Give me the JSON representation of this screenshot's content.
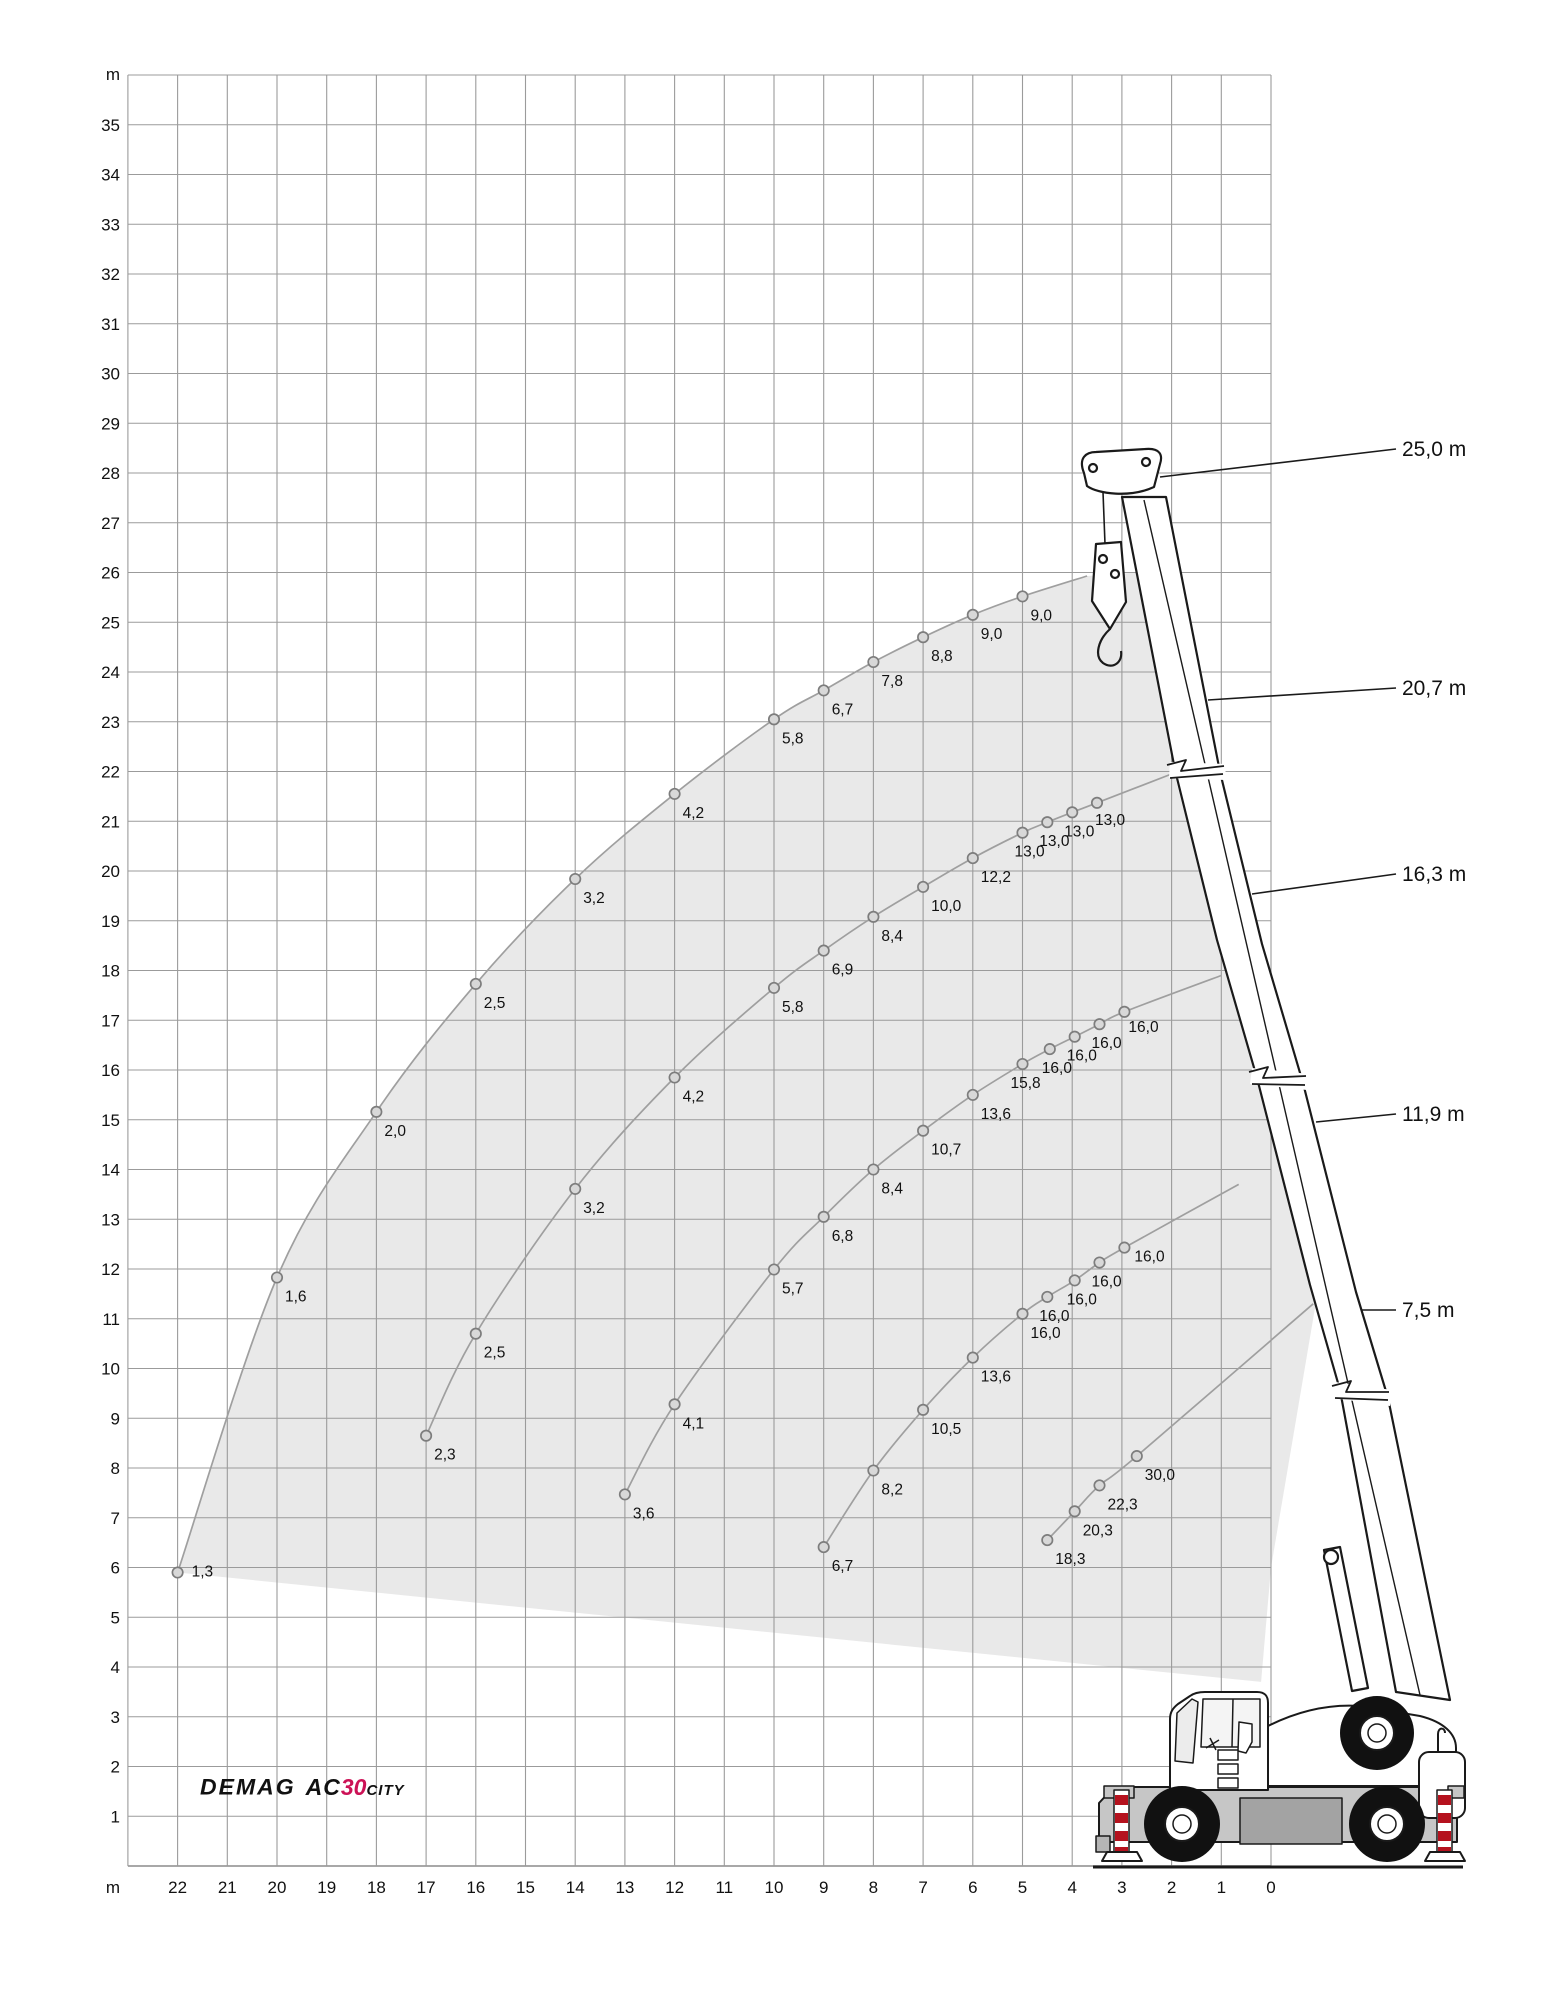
{
  "logo": {
    "brand": "DEMAG",
    "model_prefix": "AC",
    "model_number": "30",
    "model_suffix": "CITY",
    "accent": "#cc1256"
  },
  "colors": {
    "grid": "#9b9b9b",
    "envelope": "#e9e9e9",
    "curve": "#9f9f9f",
    "marker_fill": "#d8d8d8",
    "marker_stroke": "#7d7d7d",
    "text": "#111111",
    "crane_outline": "#1a1a1a",
    "deck": "#c6c6c6",
    "deck_dark": "#a3a3a3",
    "outrigger_red": "#b5121e"
  },
  "chart_data": {
    "type": "line",
    "title": "DEMAG AC30 City crane working range / load chart",
    "xlabel": "m",
    "ylabel": "m",
    "x_axis": {
      "unit": "m",
      "min": 0,
      "max": 23,
      "reversed": true,
      "tick_labels": [
        "22",
        "21",
        "20",
        "19",
        "18",
        "17",
        "16",
        "15",
        "14",
        "13",
        "12",
        "11",
        "10",
        "9",
        "8",
        "7",
        "6",
        "5",
        "4",
        "3",
        "2",
        "1",
        "0"
      ]
    },
    "y_axis": {
      "unit": "m",
      "min": 0,
      "max": 36,
      "tick_labels": [
        "35",
        "34",
        "33",
        "32",
        "31",
        "30",
        "29",
        "28",
        "27",
        "26",
        "25",
        "24",
        "23",
        "22",
        "21",
        "20",
        "19",
        "18",
        "17",
        "16",
        "15",
        "14",
        "13",
        "12",
        "11",
        "10",
        "9",
        "8",
        "7",
        "6",
        "5",
        "4",
        "3",
        "2",
        "1"
      ]
    },
    "grid": true,
    "legend_position": "right",
    "series": [
      {
        "name": "boom 25,0 m",
        "boom_length_label": "25,0 m",
        "points": [
          [
            22,
            5.9,
            "1,3",
            14,
            4
          ],
          [
            20,
            11.83,
            "1,6"
          ],
          [
            18,
            15.16,
            "2,0"
          ],
          [
            16,
            17.73,
            "2,5"
          ],
          [
            14,
            19.84,
            "3,2"
          ],
          [
            12,
            21.55,
            "4,2"
          ],
          [
            10,
            23.05,
            "5,8"
          ],
          [
            9,
            23.63,
            "6,7"
          ],
          [
            8,
            24.2,
            "7,8"
          ],
          [
            7,
            24.7,
            "8,8"
          ],
          [
            6,
            25.15,
            "9,0"
          ],
          [
            5,
            25.52,
            "9,0"
          ]
        ],
        "end": [
          3.7,
          25.93
        ]
      },
      {
        "name": "boom 20,7 m",
        "boom_length_label": "20,7 m",
        "points": [
          [
            17,
            8.65,
            "2,3"
          ],
          [
            16,
            10.7,
            "2,5"
          ],
          [
            14,
            13.61,
            "3,2"
          ],
          [
            12,
            15.85,
            "4,2"
          ],
          [
            10,
            17.65,
            "5,8"
          ],
          [
            9,
            18.4,
            "6,9"
          ],
          [
            8,
            19.08,
            "8,4"
          ],
          [
            7,
            19.68,
            "10,0"
          ],
          [
            6,
            20.26,
            "12,2"
          ],
          [
            5,
            20.77,
            "13,0",
            -8,
            24
          ],
          [
            4.5,
            20.98,
            "13,0",
            -8,
            24
          ],
          [
            4,
            21.18,
            "13,0",
            -8,
            24
          ],
          [
            3.5,
            21.37,
            "13,0",
            -2,
            22
          ]
        ],
        "end": [
          1.95,
          21.97
        ]
      },
      {
        "name": "boom 16,3 m",
        "boom_length_label": "16,3 m",
        "points": [
          [
            13,
            7.47,
            "3,6"
          ],
          [
            12,
            9.28,
            "4,1"
          ],
          [
            10,
            11.99,
            "5,7"
          ],
          [
            9,
            13.05,
            "6,8"
          ],
          [
            8,
            14.0,
            "8,4"
          ],
          [
            7,
            14.78,
            "10,7"
          ],
          [
            6,
            15.5,
            "13,6"
          ],
          [
            5,
            16.12,
            "15,8",
            -12,
            24
          ],
          [
            4.45,
            16.42,
            "16,0",
            -8,
            24
          ],
          [
            3.95,
            16.67,
            "16,0",
            -8,
            24
          ],
          [
            3.45,
            16.92,
            "16,0",
            -8,
            24
          ],
          [
            2.95,
            17.17,
            "16,0",
            4,
            20
          ]
        ],
        "end": [
          1.0,
          17.9
        ]
      },
      {
        "name": "boom 11,9 m",
        "boom_length_label": "11,9 m",
        "points": [
          [
            9,
            6.41,
            "6,7"
          ],
          [
            8,
            7.95,
            "8,2"
          ],
          [
            7,
            9.17,
            "10,5"
          ],
          [
            6,
            10.22,
            "13,6"
          ],
          [
            5,
            11.1,
            "16,0"
          ],
          [
            4.5,
            11.44,
            "16,0",
            -8,
            24
          ],
          [
            3.95,
            11.77,
            "16,0",
            -8,
            24
          ],
          [
            3.45,
            12.13,
            "16,0",
            -8,
            24
          ],
          [
            2.95,
            12.43,
            "16,0",
            10,
            14
          ]
        ],
        "end": [
          0.65,
          13.7
        ]
      },
      {
        "name": "boom 7,5 m",
        "boom_length_label": "7,5 m",
        "points": [
          [
            4.5,
            6.55,
            "18,3"
          ],
          [
            3.95,
            7.13,
            "20,3"
          ],
          [
            3.45,
            7.65,
            "22,3"
          ],
          [
            2.7,
            8.24,
            "30,0"
          ]
        ],
        "end": [
          -0.85,
          11.3
        ]
      }
    ],
    "envelope": {
      "bottom": [
        [
          22,
          5.9
        ],
        [
          0.2,
          3.7
        ]
      ],
      "right": [
        [
          0.0,
          6.0
        ],
        [
          -0.9,
          11.3
        ],
        [
          0.28,
          15.83
        ],
        [
          1.08,
          18.6
        ],
        [
          1.95,
          21.97
        ],
        [
          2.7,
          26.0
        ],
        [
          3.7,
          25.93
        ]
      ]
    },
    "units_note": "point labels are rated loads in t, axes in m"
  }
}
